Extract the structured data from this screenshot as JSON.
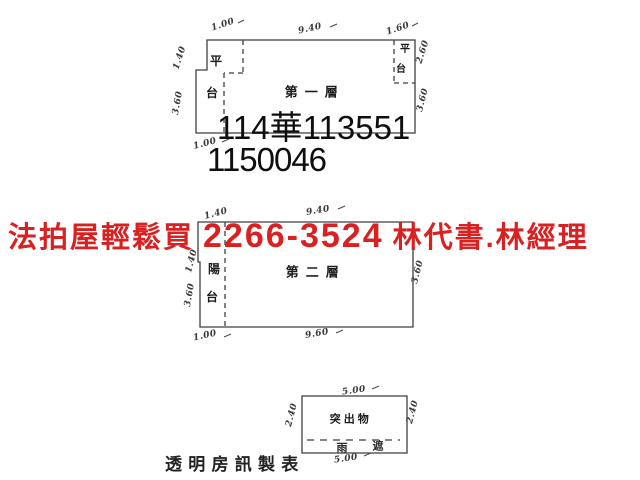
{
  "colors": {
    "ad_red": "#d92121",
    "ink": "#0e0e0e",
    "line_gray": "#3f3f3f"
  },
  "floor1": {
    "label": "第一層",
    "left_annex": [
      "平",
      "台"
    ],
    "right_annex": [
      "平",
      "台"
    ],
    "dims": {
      "top_left": "1.00",
      "top": "9.40",
      "top_right": "1.60",
      "left_upper": "1.40",
      "left_lower": "3.60",
      "right_upper": "2.60",
      "right_lower": "3.60",
      "bottom_left": "1.00"
    }
  },
  "registry": {
    "line1": "114華113551",
    "line2": "1150046"
  },
  "ad": {
    "prefix": "法拍屋輕鬆買",
    "phone": "2266-3524",
    "names": "林代書.林經理"
  },
  "floor2": {
    "label": "第二層",
    "balcony": [
      "陽",
      "台"
    ],
    "dims": {
      "top_left": "1.40",
      "top": "9.40",
      "left_upper": "1.40",
      "left_lower": "3.60",
      "right": "3.60",
      "bottom_left": "1.00",
      "bottom": "9.60"
    }
  },
  "protrusion": {
    "label": "突出物",
    "sub_chars": [
      "雨",
      "遮"
    ],
    "dims": {
      "top": "5.00",
      "left": "2.40",
      "right": "2.40",
      "bottom": "5.00"
    }
  },
  "footer": {
    "text": "透 明 房 訊 製 表"
  }
}
